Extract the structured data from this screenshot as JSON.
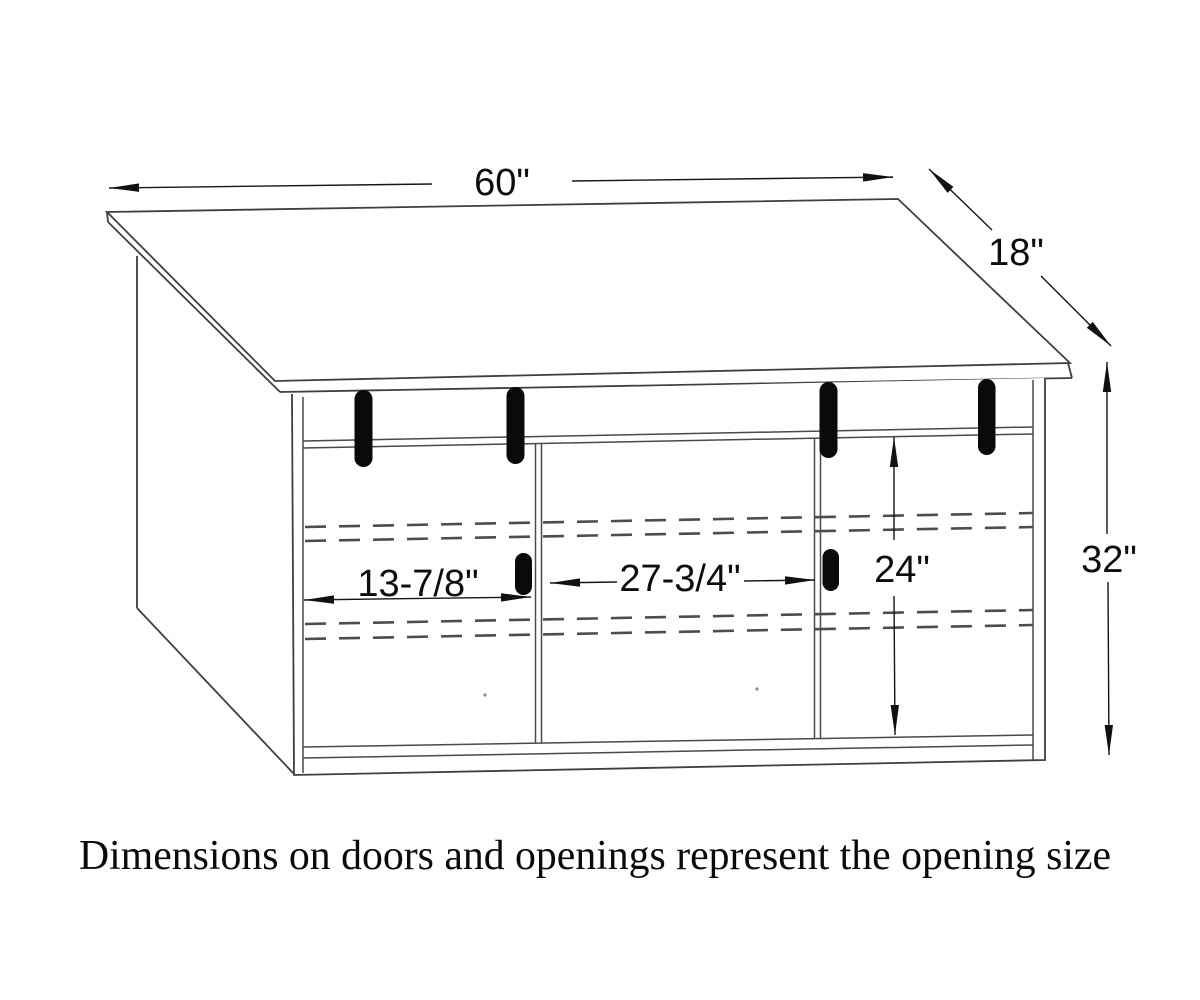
{
  "caption": "Dimensions on doors and openings represent the opening size",
  "dimensions": {
    "top_width": "60\"",
    "depth": "18\"",
    "overall_height": "32\"",
    "opening_height": "24\"",
    "left_opening_width": "13-7/8\"",
    "center_opening_width": "27-3/4\""
  },
  "colors": {
    "background": "#ffffff",
    "line": "#3f3f3f",
    "dashed_track": "#4d4d4d",
    "handle": "#0a0a0a",
    "dimension_text": "#0d0d0d"
  }
}
